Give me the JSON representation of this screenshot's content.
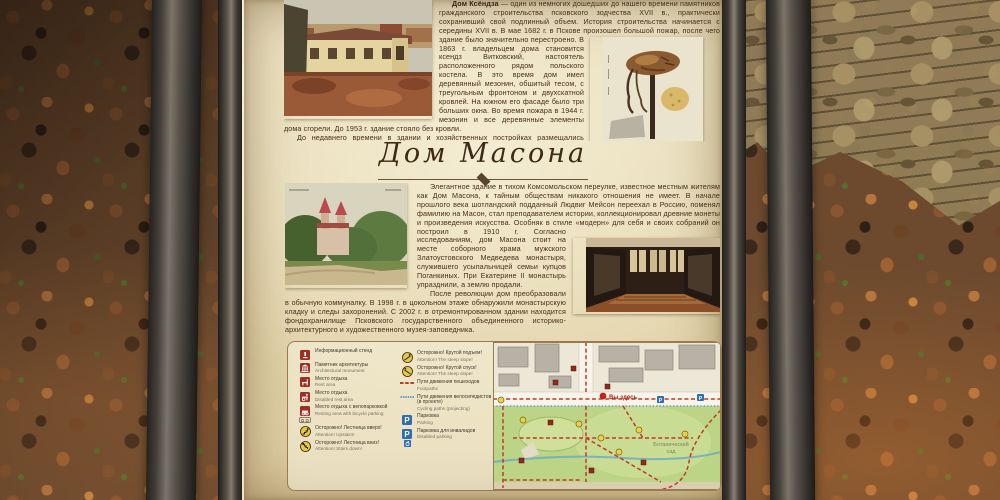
{
  "palette": {
    "paper": "#e6d9b4",
    "frame": "#3a352f",
    "post": "#4e4942",
    "bodytext": "#492d1b",
    "titletext": "#3c2a16",
    "legendred": "#9e2d22",
    "warnyellow": "#e9c93c",
    "parkblue": "#2e6db4",
    "pathred": "#c03a28",
    "cycleblue": "#4a86c8",
    "mapgreen": "#bcd485",
    "leaves": "#6d4a2e",
    "stone": "#93805a"
  },
  "sign": {
    "title": "Дом Масона",
    "ksendz": {
      "lead": "Дом Ксёндза",
      "para1a": " — один из немногих дошедших до нашего времени памятников гражданского строительства псковского зодчества XVII в., практически сохранивший свой подлинный объем. История строительства начинается с середины XVII в. В мае 1682 г. в Пскове произошел большой",
      "para1b": "пожар, после чего здание было значительно перестроено. В 1863 г. владельцем дома становится ксендз Витковский, настоятель расположенного рядом польского костела. В это время дом имел деревянный мезонин, обшитый тесом, с треугольным фронтоном и двухскатной кровлей. На южном его фасаде было три больших окна. Во время пожара в 1944 г. мезонин и все деревянные элементы дома сгорели. До 1953 г. здание стояло без кровли.",
      "para2": "До недавнего времени в здании и хозяйственных постройках размещались хозяйственная служба Псковского музея и кузнечная мастерская («Псковский Кузнечный двор»)."
    },
    "mason": {
      "para1a": "Элегантное здание в тихом Комсомольском переулке, известное местным жителям как Дом Масона, к тайным обществам никакого отношения не имеет. В начале прошлого века шотландский подданный Людвиг Мейсон переехал в Россию, поменял фамилию на Масон, стал преподавателем истории, коллекционировал древние монеты и произведения искусства. Особняк в стиле «модерн» для себя и своих собраний он построил в 1910 г. Согласно",
      "para1b": "исследованиям, дом Масона стоит на месте соборного храма мужского Златоустовского Медведева монастыря, служившего усыпальницей семьи купцов Поганкиных. При Екатерине II монастырь упразднили, а землю продали.",
      "para2": "После революции дом преобразовали в обычную коммуналку. В 1998 г. в цокольном этаже обнаружили монастырскую кладку и следы захоронений. С 2002 г. в отремонтированном здании находится фондохранилище Псковского государственного объединенного историко-архитектурного и художественного музея-заповедника."
    },
    "legend": {
      "left": [
        {
          "icon": "info-stand-icon",
          "ru": "Информационный стенд",
          "en": ""
        },
        {
          "icon": "architectural-monument-icon",
          "ru": "Памятник архитектуры",
          "en": "Architectural monument"
        },
        {
          "icon": "rest-area-icon",
          "ru": "Место отдыха",
          "en": "Rest area"
        },
        {
          "icon": "disabled-rest-area-icon",
          "ru": "Место отдыха",
          "en": "Disabled rest area"
        },
        {
          "icon": "bicycle-rest-area-icon",
          "ru": "Место отдыха с велопарковкой",
          "en": "Resting area with bicycle parking"
        },
        {
          "icon": "stairs-up-icon",
          "ru": "Осторожно! Лестница вверх!",
          "en": "Attention! Upstairs!"
        },
        {
          "icon": "stairs-down-icon",
          "ru": "Осторожно! Лестница вниз!",
          "en": "Attention! Stairs down!"
        }
      ],
      "right": [
        {
          "icon": "steep-ascent-icon",
          "ru": "Осторожно! Крутой подъем!",
          "en": "Attention! The steep slope!"
        },
        {
          "icon": "steep-descent-icon",
          "ru": "Осторожно! Крутой спуск!",
          "en": "Attention! The steep slope!"
        },
        {
          "icon": "footpath-line-icon",
          "ru": "Пути движения пешеходов",
          "en": "Footpaths"
        },
        {
          "icon": "cycling-path-line-icon",
          "ru": "Пути движения велосипедистов (в проекте)",
          "en": "Cycling paths (projecting)"
        },
        {
          "icon": "parking-icon",
          "ru": "Парковка",
          "en": "Parking"
        },
        {
          "icon": "disabled-parking-icon",
          "ru": "Парковка для инвалидов",
          "en": "Disabled parking"
        }
      ]
    },
    "map": {
      "you_are_here": "Вы здесь",
      "park_line1": "Ботанический",
      "park_line2": "сад"
    }
  }
}
